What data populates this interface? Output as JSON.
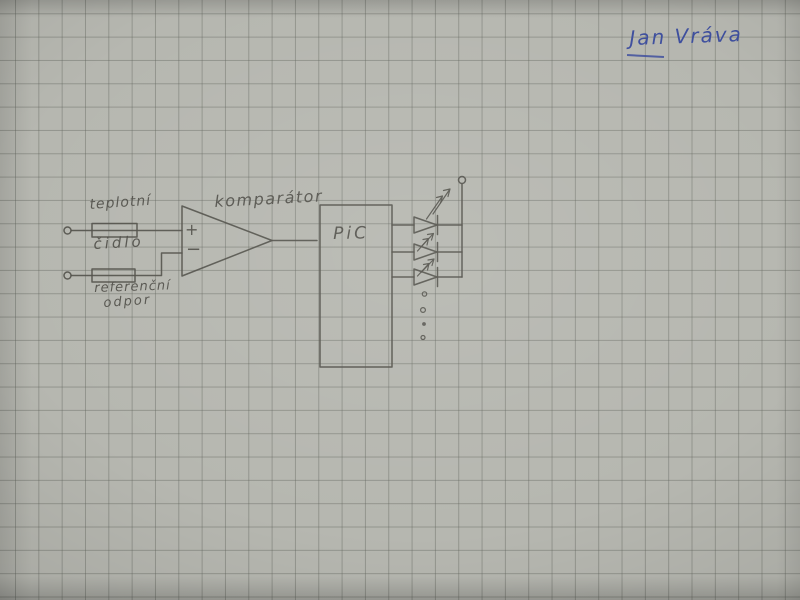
{
  "page": {
    "signature": "Jan Vráva",
    "colors": {
      "paper": "#b6b7b0",
      "grid": "#90928c",
      "pencil": "#52514b",
      "ink": "#3e4f9e"
    }
  },
  "schematic": {
    "labels": {
      "sensor_line1": "teplotní",
      "sensor_line2": "čidlo",
      "reference_line1": "referenční",
      "reference_line2": "odpor",
      "comparator": "komparátor",
      "plus": "+",
      "minus": "−",
      "pic": "PiC"
    },
    "symbols": [
      {
        "id": "input-terminal-top",
        "type": "open-terminal"
      },
      {
        "id": "temperature-sensor-resistor",
        "type": "resistor",
        "label": "teplotní čidlo"
      },
      {
        "id": "input-terminal-bottom",
        "type": "open-terminal"
      },
      {
        "id": "reference-resistor",
        "type": "resistor",
        "label": "referenční odpor"
      },
      {
        "id": "comparator",
        "type": "op-amp-triangle",
        "label": "komparátor",
        "inputs": [
          "+",
          "−"
        ]
      },
      {
        "id": "pic-mcu",
        "type": "ic-box",
        "label": "PiC",
        "output_count": 3
      },
      {
        "id": "led-1",
        "type": "led"
      },
      {
        "id": "led-2",
        "type": "led"
      },
      {
        "id": "led-3",
        "type": "led"
      },
      {
        "id": "led-continuation",
        "type": "ellipsis-dots",
        "count": 4
      },
      {
        "id": "supply-terminal",
        "type": "open-terminal"
      }
    ]
  }
}
